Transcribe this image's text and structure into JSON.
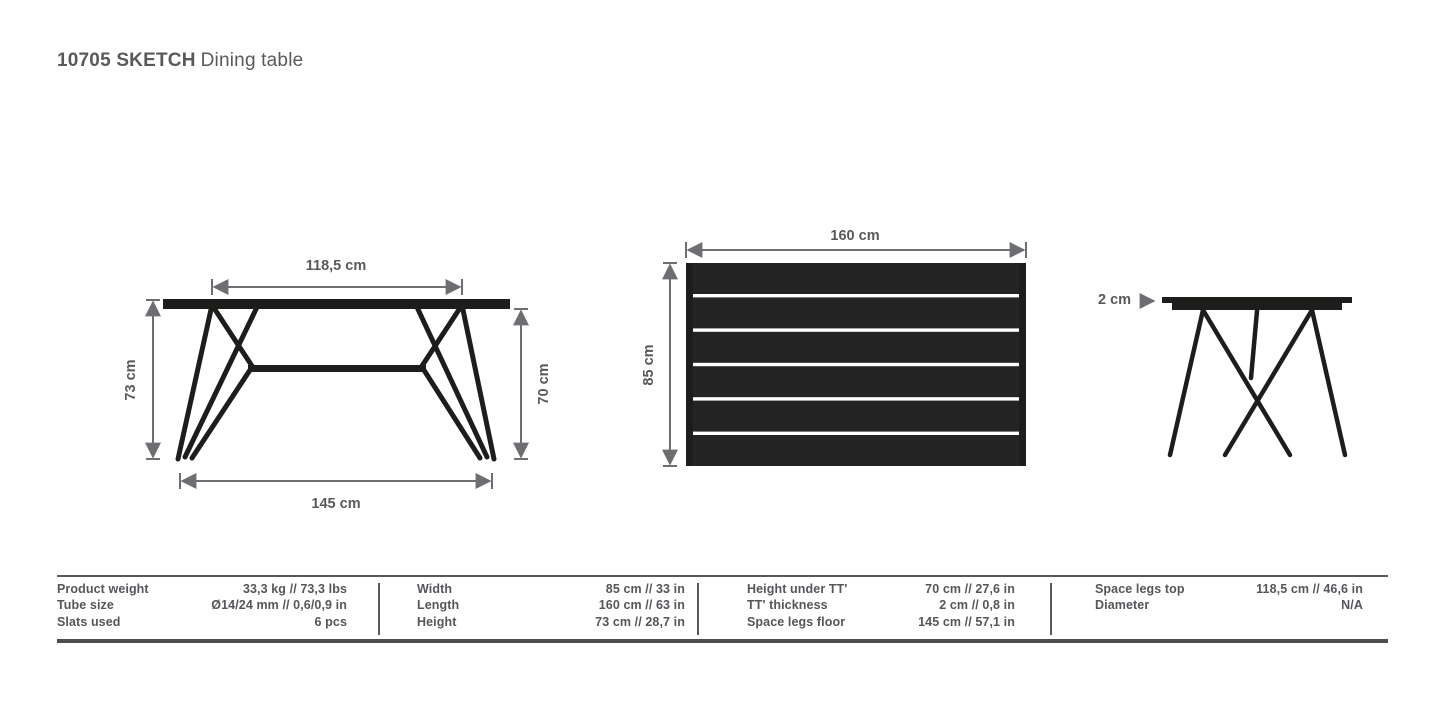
{
  "title": {
    "code": "10705 SKETCH",
    "name": "Dining table"
  },
  "colors": {
    "background": "#ffffff",
    "text": "#58595b",
    "furniture_line": "#1d1d1b",
    "dimension_line": "#6d6e71",
    "table_rule": "#4d4e50"
  },
  "drawings": {
    "front_view": {
      "dim_top": "118,5 cm",
      "dim_bottom": "145 cm",
      "dim_left": "73 cm",
      "dim_right": "70 cm"
    },
    "top_view": {
      "dim_top": "160 cm",
      "dim_left": "85 cm"
    },
    "side_view": {
      "dim_thickness": "2 cm"
    }
  },
  "spec_table": {
    "groups": [
      {
        "rows": [
          {
            "label": "Product weight",
            "value": "33,3 kg // 73,3 lbs"
          },
          {
            "label": "Tube size",
            "value": "Ø14/24 mm // 0,6/0,9 in"
          },
          {
            "label": "Slats used",
            "value": "6 pcs"
          }
        ]
      },
      {
        "rows": [
          {
            "label": "Width",
            "value": "85 cm // 33 in"
          },
          {
            "label": "Length",
            "value": "160 cm // 63 in"
          },
          {
            "label": "Height",
            "value": "73 cm // 28,7 in"
          }
        ]
      },
      {
        "rows": [
          {
            "label": "Height under TT'",
            "value": "70 cm // 27,6 in"
          },
          {
            "label": "TT' thickness",
            "value": "2 cm // 0,8 in"
          },
          {
            "label": "Space legs floor",
            "value": "145 cm // 57,1 in"
          }
        ]
      },
      {
        "rows": [
          {
            "label": "Space legs top",
            "value": "118,5 cm // 46,6 in"
          },
          {
            "label": "Diameter",
            "value": "N/A"
          }
        ]
      }
    ]
  }
}
